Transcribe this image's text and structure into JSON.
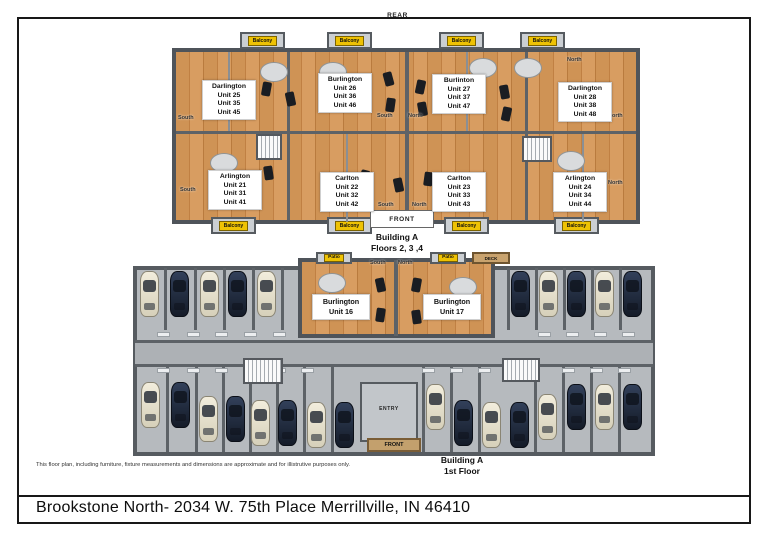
{
  "page": {
    "rear_label": "REAR",
    "disclaimer": "This floor plan, including furniture, fixture measurements and dimensions are approximate and for illistrutive purposes only.",
    "footer_title": "Brookstone North- 2034 W. 75th Place Merrillville, IN 46410"
  },
  "colors": {
    "wood": "#cf9355",
    "wall": "#53575c",
    "concrete": "#b6babe",
    "balcony_yellow": "#eec204",
    "tan": "#c3a06d",
    "car_dark": "#1f2937",
    "car_cream": "#e9e4d3"
  },
  "upper_plan": {
    "caption": [
      "Building A",
      "Floors 2, 3 ,4"
    ],
    "front_label": "FRONT",
    "balcony_label": "Balcony",
    "balconies_top": [
      {
        "x": 70
      },
      {
        "x": 157
      },
      {
        "x": 269
      },
      {
        "x": 350
      }
    ],
    "balconies_bottom": [
      {
        "x": 41
      },
      {
        "x": 157
      },
      {
        "x": 274
      },
      {
        "x": 384
      }
    ],
    "units": [
      {
        "x": 32,
        "y": 50,
        "lines": [
          "Darlington",
          "Unit 25",
          "Unit 35",
          "Unit 45"
        ]
      },
      {
        "x": 148,
        "y": 43,
        "lines": [
          "Burlington",
          "Unit 26",
          "Unit 36",
          "Unit 46"
        ]
      },
      {
        "x": 262,
        "y": 44,
        "lines": [
          "Burlinton",
          "Unit 27",
          "Unit 37",
          "Unit 47"
        ]
      },
      {
        "x": 388,
        "y": 52,
        "lines": [
          "Darlington",
          "Unit 28",
          "Unit 38",
          "Unit 48"
        ]
      },
      {
        "x": 38,
        "y": 140,
        "lines": [
          "Arlington",
          "Unit 21",
          "Unit 31",
          "Unit 41"
        ]
      },
      {
        "x": 150,
        "y": 142,
        "lines": [
          "Carlton",
          "Unit 22",
          "Unit 32",
          "Unit 42"
        ]
      },
      {
        "x": 262,
        "y": 142,
        "lines": [
          "Carlton",
          "Unit 23",
          "Unit 33",
          "Unit 43"
        ]
      },
      {
        "x": 383,
        "y": 142,
        "lines": [
          "Arlington",
          "Unit 24",
          "Unit 34",
          "Unit 44"
        ]
      }
    ],
    "directions": [
      {
        "x": 8,
        "y": 85,
        "t": "South"
      },
      {
        "x": 10,
        "y": 157,
        "t": "South"
      },
      {
        "x": 207,
        "y": 83,
        "t": "South"
      },
      {
        "x": 238,
        "y": 83,
        "t": "North"
      },
      {
        "x": 208,
        "y": 172,
        "t": "South"
      },
      {
        "x": 242,
        "y": 172,
        "t": "North"
      },
      {
        "x": 438,
        "y": 83,
        "t": "North"
      },
      {
        "x": 438,
        "y": 150,
        "t": "North"
      },
      {
        "x": 397,
        "y": 27,
        "t": "North"
      }
    ],
    "tables": [
      {
        "x": 103,
        "y": 41
      },
      {
        "x": 162,
        "y": 41
      },
      {
        "x": 312,
        "y": 37
      },
      {
        "x": 357,
        "y": 37
      },
      {
        "x": 53,
        "y": 132
      },
      {
        "x": 400,
        "y": 130
      }
    ],
    "sofas": [
      {
        "x": 92,
        "y": 52,
        "r": 10
      },
      {
        "x": 116,
        "y": 62,
        "r": -12
      },
      {
        "x": 214,
        "y": 42,
        "r": -15
      },
      {
        "x": 246,
        "y": 50,
        "r": 12
      },
      {
        "x": 216,
        "y": 68,
        "r": 8
      },
      {
        "x": 248,
        "y": 72,
        "r": -10
      },
      {
        "x": 330,
        "y": 55,
        "r": -10
      },
      {
        "x": 332,
        "y": 77,
        "r": 12
      },
      {
        "x": 190,
        "y": 140,
        "r": 15
      },
      {
        "x": 224,
        "y": 148,
        "r": -12
      },
      {
        "x": 254,
        "y": 142,
        "r": 8
      },
      {
        "x": 94,
        "y": 136,
        "r": -8
      }
    ]
  },
  "lower_plan": {
    "caption": [
      "Building A",
      "1st Floor"
    ],
    "front_label": "FRONT",
    "entry_label": "ENTRY",
    "deck_label": "DECK",
    "patio_label": "Patio",
    "patios": [
      {
        "x": 186
      },
      {
        "x": 300
      }
    ],
    "directions": [
      {
        "x": 240,
        "y": 8,
        "t": "South"
      },
      {
        "x": 268,
        "y": 8,
        "t": "North"
      }
    ],
    "units": [
      {
        "x": 182,
        "y": 42,
        "lines": [
          "Burlington",
          "Unit 16"
        ]
      },
      {
        "x": 293,
        "y": 42,
        "lines": [
          "Burlington",
          "Unit 17"
        ]
      }
    ],
    "tables": [
      {
        "x": 201,
        "y": 30
      },
      {
        "x": 332,
        "y": 34
      }
    ],
    "sofas": [
      {
        "x": 246,
        "y": 26,
        "r": -12
      },
      {
        "x": 282,
        "y": 26,
        "r": 10
      },
      {
        "x": 246,
        "y": 56,
        "r": 8
      },
      {
        "x": 282,
        "y": 58,
        "r": -8
      }
    ],
    "cars": [
      {
        "x": 20,
        "y": 19,
        "c": "cream"
      },
      {
        "x": 50,
        "y": 19,
        "c": "dark"
      },
      {
        "x": 80,
        "y": 19,
        "c": "cream"
      },
      {
        "x": 108,
        "y": 19,
        "c": "dark"
      },
      {
        "x": 137,
        "y": 19,
        "c": "cream"
      },
      {
        "x": 391,
        "y": 19,
        "c": "dark"
      },
      {
        "x": 419,
        "y": 19,
        "c": "cream"
      },
      {
        "x": 447,
        "y": 19,
        "c": "dark"
      },
      {
        "x": 475,
        "y": 19,
        "c": "cream"
      },
      {
        "x": 503,
        "y": 19,
        "c": "dark"
      },
      {
        "x": 21,
        "y": 130,
        "c": "cream"
      },
      {
        "x": 51,
        "y": 130,
        "c": "dark"
      },
      {
        "x": 79,
        "y": 144,
        "c": "cream"
      },
      {
        "x": 106,
        "y": 144,
        "c": "dark"
      },
      {
        "x": 131,
        "y": 148,
        "c": "cream"
      },
      {
        "x": 158,
        "y": 148,
        "c": "dark"
      },
      {
        "x": 187,
        "y": 150,
        "c": "cream"
      },
      {
        "x": 215,
        "y": 150,
        "c": "dark"
      },
      {
        "x": 306,
        "y": 132,
        "c": "cream"
      },
      {
        "x": 334,
        "y": 148,
        "c": "dark"
      },
      {
        "x": 362,
        "y": 150,
        "c": "cream"
      },
      {
        "x": 390,
        "y": 150,
        "c": "dark"
      },
      {
        "x": 418,
        "y": 142,
        "c": "cream"
      },
      {
        "x": 447,
        "y": 132,
        "c": "dark"
      },
      {
        "x": 475,
        "y": 132,
        "c": "cream"
      },
      {
        "x": 503,
        "y": 132,
        "c": "dark"
      }
    ],
    "divider_groups": [
      {
        "y": 16,
        "h": 62,
        "xs": [
          34,
          64,
          93,
          122,
          151
        ]
      },
      {
        "y": 16,
        "h": 62,
        "xs": [
          377,
          405,
          433,
          461,
          489
        ]
      },
      {
        "y": 114,
        "h": 86,
        "xs": [
          36,
          65,
          92,
          119,
          146,
          173,
          201
        ]
      },
      {
        "y": 114,
        "h": 86,
        "xs": [
          292,
          320,
          348,
          404,
          432,
          460,
          488
        ]
      }
    ],
    "chip_rows": [
      {
        "y": 80,
        "xs": [
          27,
          57,
          85,
          114,
          143,
          408,
          436,
          464,
          492
        ]
      },
      {
        "y": 116,
        "xs": [
          27,
          57,
          85,
          114,
          143,
          171,
          292,
          320,
          348,
          432,
          460,
          488
        ]
      }
    ]
  }
}
